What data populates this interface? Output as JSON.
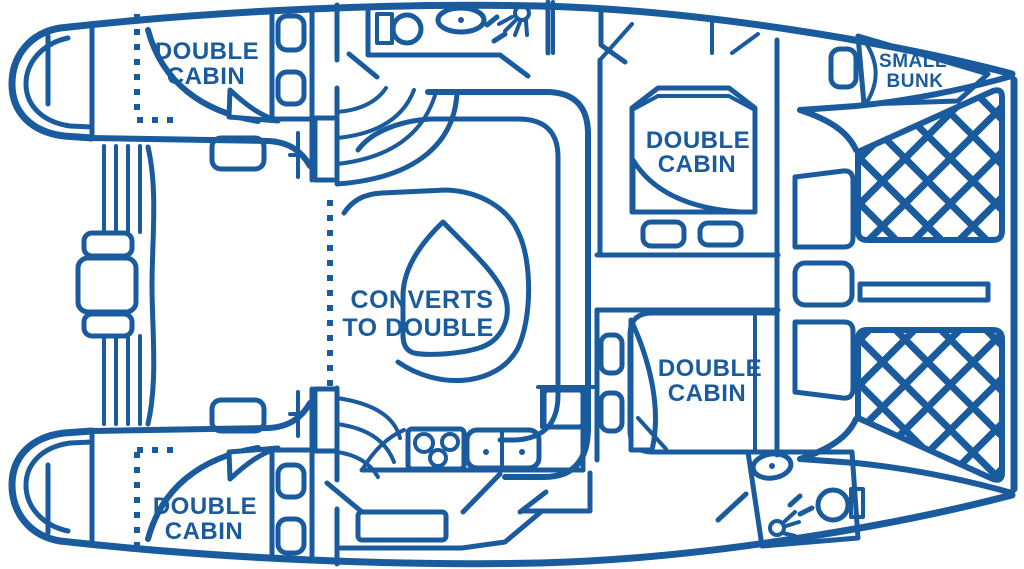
{
  "diagram": {
    "type": "catamaran-interior-floor-plan",
    "orientation": "bow-right",
    "colors": {
      "line": "#1A5B9E",
      "background": "#FFFFFF"
    },
    "labels": {
      "cabin_aft_port": {
        "line1": "DOUBLE",
        "line2": "CABIN"
      },
      "cabin_aft_starboard": {
        "line1": "DOUBLE",
        "line2": "CABIN"
      },
      "cabin_fwd_port": {
        "line1": "DOUBLE",
        "line2": "CABIN"
      },
      "cabin_fwd_starboard": {
        "line1": "DOUBLE",
        "line2": "CABIN"
      },
      "forepeak_bunk": {
        "line1": "SMALL",
        "line2": "BUNK"
      },
      "salon_table": {
        "line1": "CONVERTS",
        "line2": "TO DOUBLE"
      }
    },
    "features": {
      "double_cabins": 4,
      "small_bunks": 1,
      "heads": 2,
      "galley": true,
      "salon_converts_to_double": true,
      "bow_trampolines": 2
    }
  }
}
